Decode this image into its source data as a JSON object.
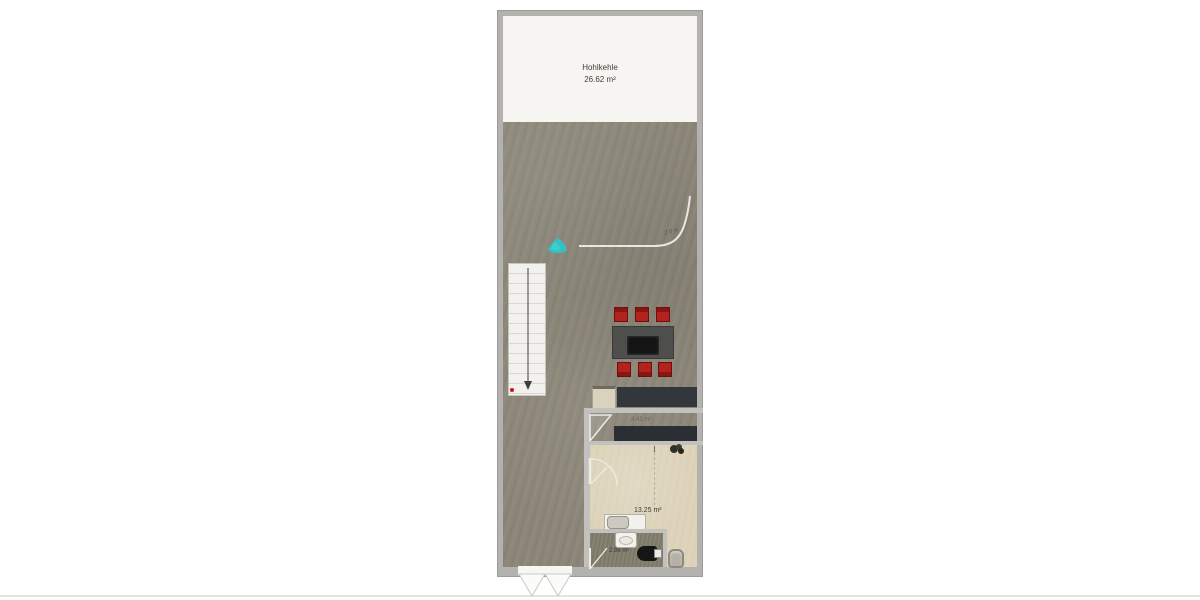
{
  "plan": {
    "attic": {
      "name": "Hohlkehle",
      "area": "26.62 m²"
    },
    "kitchen": {
      "area": "4.43 m²"
    },
    "room": {
      "area": "13.25 m²"
    },
    "bathroom": {
      "area": "2.98 m²"
    },
    "height_line_label": "2.0 m",
    "colors": {
      "outer_wall": "#b4b2ae",
      "attic_floor": "#f6f5f1",
      "main_floor": "#8b8678",
      "room_floor": "#ded4bb",
      "bath_floor": "#827e6d",
      "counter": "#2e3136",
      "table": "#4e4e4d",
      "chair": "#b3231d",
      "stairs": "#f1f0ec",
      "plant_teal": "#2fc3c6",
      "stair_marker": "#c0181c"
    }
  }
}
